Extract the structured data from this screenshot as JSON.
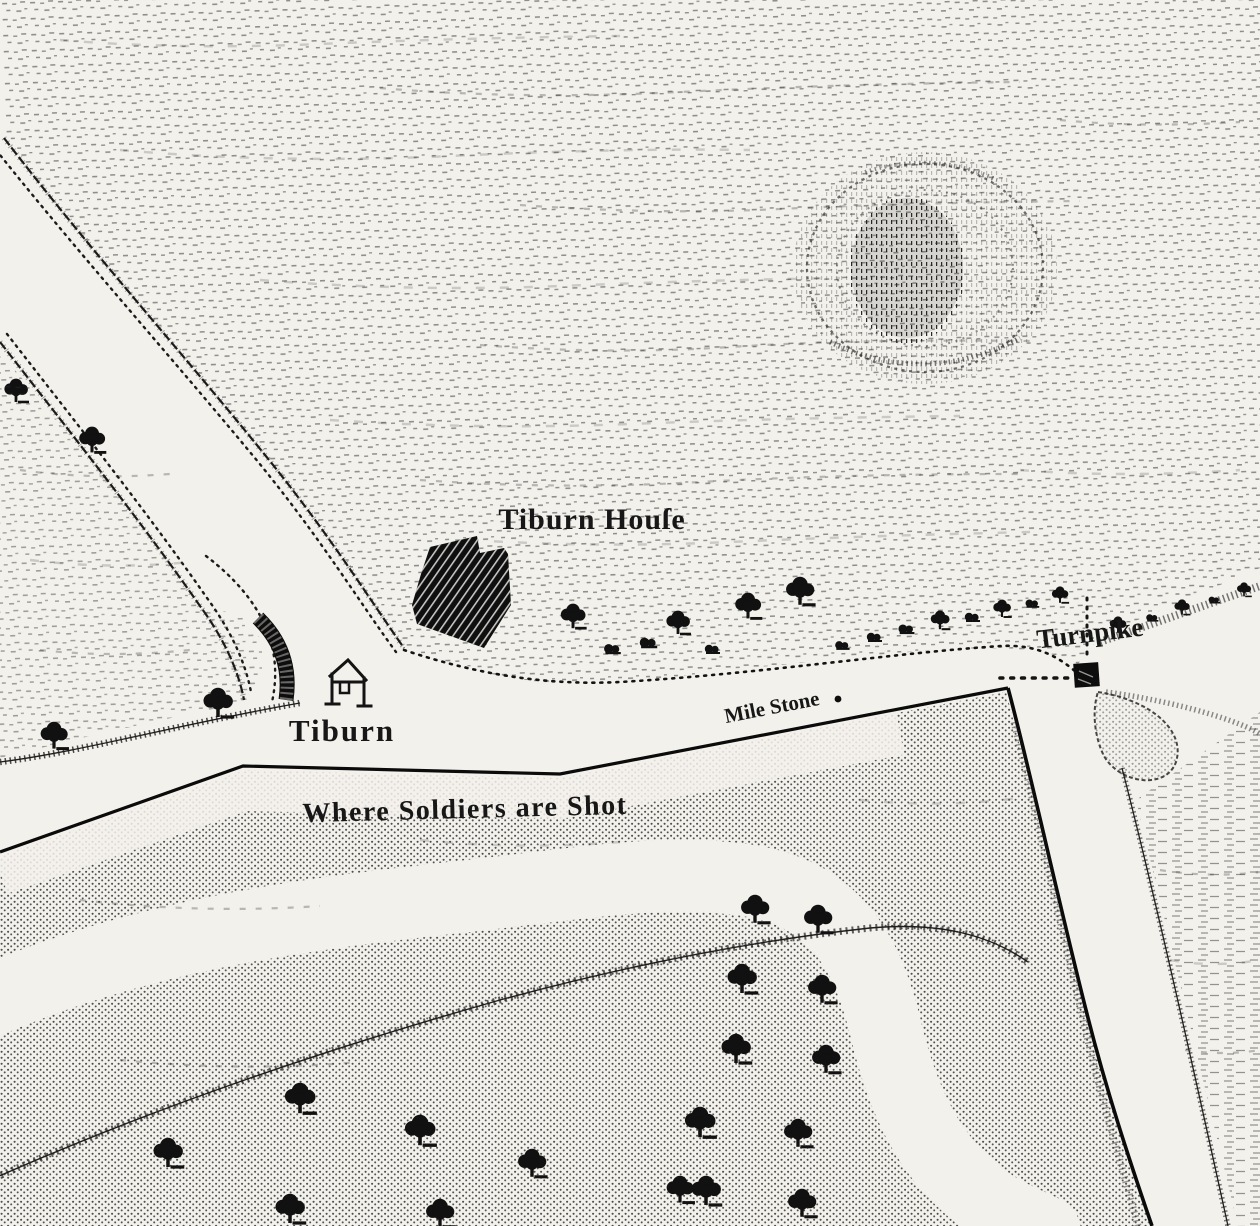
{
  "map": {
    "type": "engraved-historical-map",
    "labels": {
      "tiburn_house": "Tiburn Houſe",
      "turnpike": "Turnpike",
      "tiburn": "Tiburn",
      "mile_stone": "Mile Stone",
      "where_soldiers_are_shot": "Where Soldiers are Shot"
    },
    "icons": {
      "gallows-icon": "tyburn gallows frame with crossbar",
      "turnpike-gate-icon": "solid black square gate",
      "milestone-dot-icon": "black dot",
      "tree-icon": "black deciduous tree with shadow stroke",
      "bush-icon": "small black shrub",
      "building-icon": "hatched black building footprint",
      "tree-clump-icon": "circular sketched copse",
      "pond-icon": "stippled teardrop pond"
    },
    "colors": {
      "paper": "#f3f1ec",
      "ink": "#141414"
    }
  }
}
